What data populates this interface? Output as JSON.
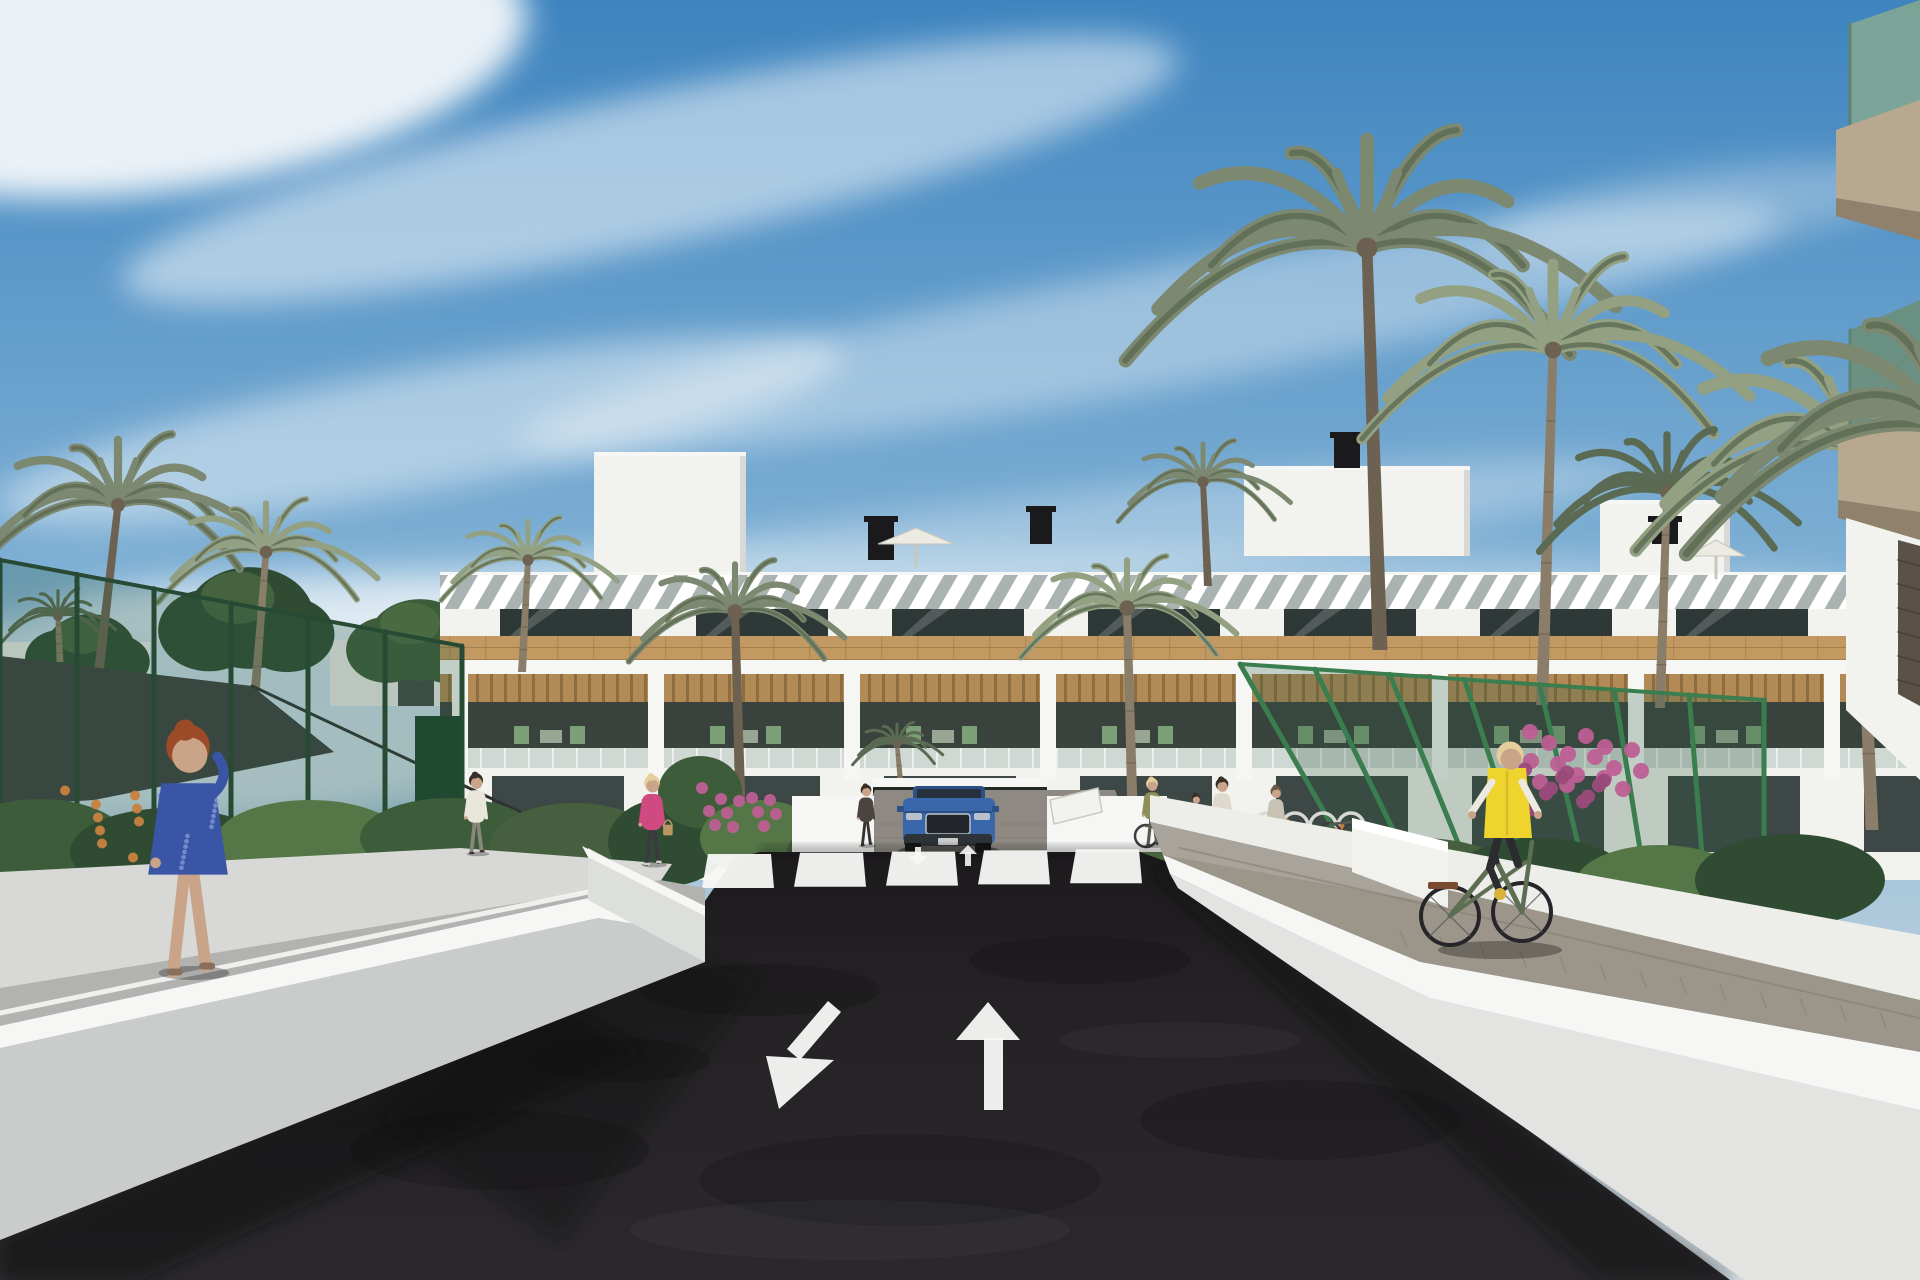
{
  "meta": {
    "title": "Architectural render: residential complex street view with palm trees, road arrows, pedestrians and cyclist",
    "width": 1920,
    "height": 1280
  },
  "palette": {
    "skyTop": "#3e84bf",
    "skyMid": "#7fb0d4",
    "skyLow": "#b9cfdd",
    "skyHaze": "#d8e2e8",
    "cloud": "#f4f8fa",
    "bldgFace": "#f2f2ee",
    "capWhite": "#f6f7f5",
    "wallBright": "#ededea",
    "wallShade": "#d8d9d6",
    "wallFaceL": "#c9cccb",
    "wallFaceR": "#e3e4e1",
    "rampFace": "#dddfdd",
    "sidewalk": "#a8a49c",
    "louvGap": "#aab3b1",
    "winDark": "#2e3836",
    "winLite": "#55645f",
    "wood": "#c29a61",
    "woodLine": "#a37f4e",
    "slatWood": "#b28a55",
    "slatDark": "#8d6c40",
    "interior": "#3a423e",
    "glass": "#b9c6c2",
    "chairGreen": "#7ba077",
    "road": "#242224",
    "roadTop": "#1c1a1c",
    "pathGray": "#b2b3b0",
    "paver": "#9c958a",
    "paverLine": "#847d72",
    "drivePaver": "#8e8a83",
    "garage": "#222925",
    "fenceGreen": "#2f5c40",
    "fencePost": "#264a33",
    "fencePostLite": "#3a7d4e",
    "sail": "#3c403f",
    "frond": "#7c886f",
    "frondDark": "#5b6a52",
    "frondLite": "#93a082",
    "trunk": "#8a7d69",
    "trunkDark": "#6d6252",
    "hedge1": "#3d5c3a",
    "hedge2": "#557747",
    "hedge3": "#2f4c33",
    "hedge4": "#46603f",
    "flowerOrange": "#c8823f",
    "flowerPink": "#bd5f95",
    "flowerPinkDk": "#9a4a7a",
    "carBlue": "#3a66ab",
    "carBlueDk": "#2c4f86",
    "carGlass": "#26313d",
    "carGrille": "#23262b",
    "carSilver": "#b9c2cc",
    "skin": "#c9a489",
    "hairRed": "#9c4b28",
    "hairBlonde": "#e4cf9b",
    "hairDark": "#372e25",
    "vestYellow": "#f0d42e",
    "bikeGreen": "#5d6e52",
    "dark": "#1a1a1c",
    "fgSlab": "#b7a88f",
    "fgSlabDk": "#8f816b",
    "fgGlass": "#7fa695",
    "fgGlassDk": "#6a8f80",
    "fgFrame": "#5f8372",
    "stone": "#5a5248",
    "white": "#ffffff",
    "black": "#000000"
  },
  "scene": {
    "clouds": [
      {
        "n": "cloud-bright-topleft",
        "cx": 170,
        "cy": 60,
        "rx": 360,
        "ry": 130,
        "rot": -8,
        "o": 0.95
      },
      {
        "n": "cloud-band-1",
        "cx": 650,
        "cy": 170,
        "rx": 540,
        "ry": 75,
        "rot": -12,
        "o": 0.55
      },
      {
        "n": "cloud-band-2",
        "cx": 1150,
        "cy": 330,
        "rx": 640,
        "ry": 60,
        "rot": -10,
        "o": 0.4
      },
      {
        "n": "cloud-band-3",
        "cx": 420,
        "cy": 430,
        "rx": 430,
        "ry": 60,
        "rot": -10,
        "o": 0.48
      },
      {
        "n": "cloud-band-4",
        "cx": 950,
        "cy": 555,
        "rx": 700,
        "ry": 48,
        "rot": -7,
        "o": 0.3
      },
      {
        "n": "cloud-wisp-right",
        "cx": 1700,
        "cy": 210,
        "rx": 210,
        "ry": 40,
        "rot": -8,
        "o": 0.3
      },
      {
        "n": "cloud-haze-left-low",
        "cx": 250,
        "cy": 700,
        "rx": 430,
        "ry": 115,
        "rot": -4,
        "o": 0.6
      },
      {
        "n": "cloud-haze-horizon",
        "cx": 1000,
        "cy": 608,
        "rx": 950,
        "ry": 60,
        "rot": 0,
        "o": 0.32
      }
    ],
    "horizon": [
      {
        "t": "rect",
        "n": "distant-wall-left",
        "x": 0,
        "y": 642,
        "w": 150,
        "h": 44,
        "f": "wallBright",
        "o": 0.95
      },
      {
        "t": "rect",
        "n": "distant-wall-mid",
        "x": 330,
        "y": 640,
        "w": 172,
        "h": 66,
        "f": "wallBright",
        "o": 0.95
      },
      {
        "t": "rect",
        "n": "distant-doorway",
        "x": 398,
        "y": 656,
        "w": 36,
        "h": 50,
        "f": "winDark",
        "o": 0.9
      }
    ],
    "trees": [
      {
        "cx": 90,
        "cy": 650,
        "r": 58,
        "f": "hedge3"
      },
      {
        "cx": 250,
        "cy": 618,
        "r": 82,
        "f": "hedge3"
      },
      {
        "cx": 420,
        "cy": 640,
        "r": 66,
        "f": "hedge1"
      },
      {
        "cx": 640,
        "cy": 662,
        "r": 54,
        "f": "hedge4"
      },
      {
        "cx": 1500,
        "cy": 644,
        "r": 58,
        "f": "hedge3"
      },
      {
        "cx": 1700,
        "cy": 668,
        "r": 64,
        "f": "hedge1"
      }
    ],
    "building": {
      "x0": 440,
      "x1": 1920,
      "topY": 572,
      "louver": [
        575,
        609
      ],
      "windows": [
        609,
        636
      ],
      "wood": [
        636,
        660
      ],
      "beam": [
        660,
        674
      ],
      "slats": [
        674,
        702
      ],
      "interior": [
        702,
        748
      ],
      "glassRail": [
        748,
        768
      ],
      "baseBottom": 880,
      "pierStart": 452,
      "pierStep": 196,
      "pierW": 16,
      "penthouses": [
        [
          594,
          452,
          152,
          120
        ],
        [
          1244,
          466,
          226,
          90
        ],
        [
          1600,
          500,
          130,
          72
        ]
      ],
      "vents": [
        [
          868,
          516,
          26,
          44
        ],
        [
          1030,
          506,
          22,
          38
        ],
        [
          1334,
          432,
          26,
          36
        ],
        [
          1652,
          516,
          26,
          28
        ]
      ],
      "umbrellas": [
        {
          "x": 916,
          "y": 566,
          "w": 76
        },
        {
          "x": 1716,
          "y": 578,
          "w": 58
        }
      ],
      "groundWin": [
        680,
        844
      ]
    },
    "palms": [
      {
        "n": "palm-left-tall",
        "bx": 95,
        "by": 705,
        "tx": 118,
        "ty": 505,
        "r": 150,
        "tw": 10,
        "v": 0
      },
      {
        "n": "palm-left-2",
        "bx": 255,
        "by": 695,
        "tx": 266,
        "ty": 552,
        "r": 112,
        "tw": 9,
        "v": 1
      },
      {
        "n": "fan-palm-left",
        "bx": 60,
        "by": 662,
        "tx": 58,
        "ty": 616,
        "r": 58,
        "tw": 7,
        "v": 2
      },
      {
        "n": "palm-mid-left",
        "bx": 522,
        "by": 672,
        "tx": 528,
        "ty": 560,
        "r": 90,
        "tw": 8,
        "v": 1
      },
      {
        "n": "palm-courtyard-left",
        "bx": 742,
        "by": 866,
        "tx": 735,
        "ty": 612,
        "r": 110,
        "tw": 11,
        "v": 0
      },
      {
        "n": "palm-entrance",
        "bx": 902,
        "by": 798,
        "tx": 897,
        "ty": 744,
        "r": 46,
        "tw": 6,
        "v": 2
      },
      {
        "n": "palm-courtyard-right",
        "bx": 1134,
        "by": 866,
        "tx": 1127,
        "ty": 608,
        "r": 110,
        "tw": 11,
        "v": 1
      },
      {
        "n": "palm-roofline",
        "bx": 1208,
        "by": 586,
        "tx": 1203,
        "ty": 482,
        "r": 88,
        "tw": 8,
        "v": 0
      },
      {
        "n": "palm-right-tall",
        "bx": 1380,
        "by": 650,
        "tx": 1367,
        "ty": 248,
        "r": 250,
        "tw": 15,
        "v": 0
      },
      {
        "n": "palm-right-2",
        "bx": 1542,
        "by": 705,
        "tx": 1553,
        "ty": 350,
        "r": 198,
        "tw": 12,
        "v": 1
      },
      {
        "n": "palm-right-3",
        "bx": 1660,
        "by": 708,
        "tx": 1667,
        "ty": 492,
        "r": 132,
        "tw": 10,
        "v": 2
      },
      {
        "n": "palm-right-edge",
        "bx": 1872,
        "by": 830,
        "tx": 1856,
        "ty": 448,
        "r": 228,
        "tw": 13,
        "v": 1
      }
    ],
    "frontFronds": {
      "n": "overhanging-palm-fronds",
      "tx": 1952,
      "ty": 430,
      "r": 275,
      "v": 0
    },
    "fences": [
      {
        "n": "court-fence-left",
        "top": [
          [
            0,
            560
          ],
          [
            462,
            646
          ]
        ],
        "bot": [
          [
            0,
            884
          ],
          [
            462,
            852
          ]
        ],
        "posts": 6,
        "lite": false
      },
      {
        "n": "garden-fence-right",
        "top": [
          [
            1240,
            664
          ],
          [
            1764,
            700
          ]
        ],
        "bot": [
          [
            1356,
            868
          ],
          [
            1764,
            906
          ]
        ],
        "posts": 7,
        "lite": true
      }
    ],
    "sail": {
      "pts": [
        [
          0,
          656
        ],
        [
          252,
          686
        ],
        [
          334,
          752
        ],
        [
          94,
          800
        ],
        [
          0,
          806
        ]
      ],
      "cable": [
        [
          252,
          686
        ],
        [
          520,
          812
        ]
      ]
    },
    "gardens": [
      {
        "t": "ell",
        "cx": 40,
        "cy": 845,
        "rx": 90,
        "ry": 46,
        "f": "hedge1"
      },
      {
        "t": "ell",
        "cx": 170,
        "cy": 852,
        "rx": 100,
        "ry": 44,
        "f": "hedge3"
      },
      {
        "t": "ell",
        "cx": 310,
        "cy": 842,
        "rx": 95,
        "ry": 42,
        "f": "hedge2"
      },
      {
        "t": "ell",
        "cx": 450,
        "cy": 838,
        "rx": 90,
        "ry": 40,
        "f": "hedge1"
      },
      {
        "t": "ell",
        "cx": 575,
        "cy": 845,
        "rx": 85,
        "ry": 42,
        "f": "hedge4"
      },
      {
        "t": "ell",
        "cx": 668,
        "cy": 842,
        "rx": 60,
        "ry": 44,
        "f": "hedge3"
      },
      {
        "t": "ell",
        "cx": 700,
        "cy": 792,
        "rx": 42,
        "ry": 36,
        "f": "hedge1"
      },
      {
        "t": "ell",
        "cx": 760,
        "cy": 838,
        "rx": 60,
        "ry": 38,
        "f": "hedge2"
      },
      {
        "t": "ell",
        "cx": 835,
        "cy": 852,
        "rx": 48,
        "ry": 30,
        "f": "hedge4"
      },
      {
        "t": "ell",
        "cx": 1085,
        "cy": 842,
        "rx": 60,
        "ry": 40,
        "f": "hedge3"
      },
      {
        "t": "ell",
        "cx": 1190,
        "cy": 858,
        "rx": 80,
        "ry": 36,
        "f": "hedge2"
      },
      {
        "t": "ell",
        "cx": 1300,
        "cy": 862,
        "rx": 90,
        "ry": 38,
        "f": "hedge1"
      },
      {
        "t": "ell",
        "cx": 1420,
        "cy": 878,
        "rx": 95,
        "ry": 40,
        "f": "hedge4"
      },
      {
        "t": "ell",
        "cx": 1540,
        "cy": 880,
        "rx": 90,
        "ry": 42,
        "f": "hedge3"
      },
      {
        "t": "ell",
        "cx": 1660,
        "cy": 885,
        "rx": 85,
        "ry": 40,
        "f": "hedge2"
      },
      {
        "t": "ell",
        "cx": 1790,
        "cy": 880,
        "rx": 95,
        "ry": 46,
        "f": "hedge3"
      },
      {
        "t": "dots",
        "n": "orange-flowers-left",
        "cx": 140,
        "cy": 828,
        "spread": 150,
        "r": 5,
        "count": 16,
        "f": "flowerOrange"
      },
      {
        "t": "dots",
        "n": "pink-flowers-median",
        "cx": 742,
        "cy": 808,
        "spread": 80,
        "r": 6,
        "count": 12,
        "f": "flowerPink"
      },
      {
        "t": "dots",
        "n": "orange-flowers-right-1",
        "cx": 1295,
        "cy": 850,
        "spread": 130,
        "r": 5,
        "count": 14,
        "f": "flowerOrange"
      },
      {
        "t": "dots",
        "n": "orange-flowers-right-2",
        "cx": 1480,
        "cy": 872,
        "spread": 110,
        "r": 5,
        "count": 12,
        "f": "flowerOrange"
      },
      {
        "t": "dots",
        "n": "bougainvillea-right-fence",
        "cx": 1590,
        "cy": 762,
        "spread": 120,
        "r": 8,
        "count": 16,
        "f": "flowerPink"
      },
      {
        "t": "dots",
        "n": "bougainvillea-right-dark",
        "cx": 1570,
        "cy": 792,
        "spread": 90,
        "r": 7,
        "count": 10,
        "f": "flowerPinkDk"
      }
    ],
    "crosswalk": {
      "x0": 702,
      "count": 5,
      "pitch": 92,
      "w": 72,
      "yBottom": 888,
      "yTop": 854
    },
    "arrows": {
      "bigDownLeftShaft": [
        [
          828,
          1001
        ],
        [
          841,
          1012
        ],
        [
          800,
          1060
        ],
        [
          787,
          1049
        ]
      ],
      "bigDownLeftHead": [
        [
          766,
          1056
        ],
        [
          834,
          1060
        ],
        [
          779,
          1109
        ]
      ],
      "bigUpShaft": [
        [
          984,
          1038
        ],
        [
          1003,
          1038
        ],
        [
          1003,
          1110
        ],
        [
          984,
          1110
        ]
      ],
      "bigUpHead": [
        [
          956,
          1040
        ],
        [
          1020,
          1040
        ],
        [
          988,
          1002
        ]
      ],
      "smallDownShaft": [
        [
          915,
          847
        ],
        [
          921,
          847
        ],
        [
          921,
          858
        ],
        [
          915,
          858
        ]
      ],
      "smallDownHead": [
        [
          909,
          856
        ],
        [
          927,
          856
        ],
        [
          918,
          866
        ]
      ],
      "smallUpShaft": [
        [
          965,
          852
        ],
        [
          971,
          852
        ],
        [
          971,
          866
        ],
        [
          965,
          866
        ]
      ],
      "smallUpHead": [
        [
          959,
          854
        ],
        [
          977,
          854
        ],
        [
          968,
          845
        ]
      ]
    },
    "car": {
      "n": "blue-suv",
      "x": 903,
      "y": 786
    },
    "bikeRacks": {
      "x0": 1226,
      "y": 826,
      "count": 5,
      "gap": 28
    },
    "people": [
      {
        "n": "woman-blue-dress-phone",
        "x": 188,
        "fy": 972,
        "h": 295,
        "hair": "hairRed",
        "top": "#3b55a6",
        "bottom": "skin",
        "dress": true,
        "phone": true,
        "shoe": "#8a6f5c"
      },
      {
        "n": "man-white-shirt",
        "x": 476,
        "fy": 853,
        "h": 95,
        "hair": "hairDark",
        "top": "#e9e6db",
        "bottom": "#8a867c",
        "shoe": "#3a3632"
      },
      {
        "n": "woman-pink-jacket",
        "x": 652,
        "fy": 864,
        "h": 106,
        "hair": "hairBlonde",
        "top": "#cf4a80",
        "bottom": "#3a3a40",
        "bag": "#b99766",
        "shoe": "#d8d2c6"
      },
      {
        "n": "woman-dark-entrance",
        "x": 866,
        "fy": 845,
        "h": 72,
        "hair": "hairDark",
        "top": "#4a4440",
        "bottom": "#35322f",
        "shoe": "#2a2826"
      },
      {
        "n": "woman-olive-vest",
        "x": 1152,
        "fy": 845,
        "h": 80,
        "hair": "hairBlonde",
        "top": "#8f8f58",
        "bottom": "#5a5a50",
        "shoe": "#3a3632"
      },
      {
        "n": "child-dark",
        "x": 1196,
        "fy": 844,
        "h": 60,
        "hair": "hairDark",
        "top": "#6b645c",
        "bottom": "#44403c",
        "shoe": "#2a2826"
      },
      {
        "n": "man-white-top",
        "x": 1222,
        "fy": 850,
        "h": 86,
        "hair": "hairDark",
        "top": "#ded9cf",
        "bottom": "#3f3e44",
        "shoe": "#2a2826"
      },
      {
        "n": "person-gray-right",
        "x": 1276,
        "fy": 848,
        "h": 74,
        "hair": "#6b5a43",
        "top": "#c7c2b4",
        "bottom": "#55524c",
        "shoe": "#3a3632"
      }
    ],
    "cyclist": {
      "n": "cyclist-yellow-vest",
      "rearWheel": [
        1450,
        916
      ],
      "frontWheel": [
        1522,
        912
      ],
      "wheelR": 29,
      "saddle": [
        1494,
        846
      ],
      "bars": [
        1532,
        842
      ],
      "head": [
        1510,
        757
      ],
      "vest": "vestYellow",
      "sleeves": "#ece9e0",
      "pants": "#2b2b30",
      "frame": "bikeGreen",
      "shoe": "#d9b23c",
      "hair": "hairBlonde"
    }
  }
}
